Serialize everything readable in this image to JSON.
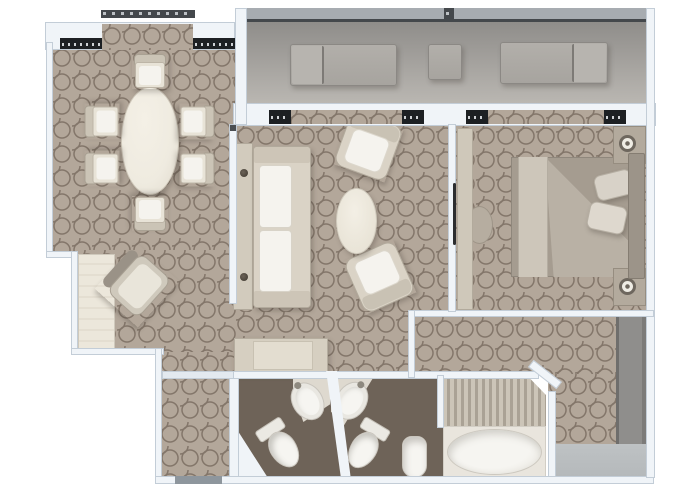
{
  "type": "floor-plan",
  "title": "Suite floor plan (top-down 3D render, no text labels in image)",
  "palette": {
    "background": "#ffffff",
    "wall": "#f0f4f8",
    "wall_edge": "#c3cdd7",
    "carpet": "#b3a79a",
    "carpet_line": "#83766a",
    "balcony_floor_light": "#bab7b2",
    "balcony_floor_dark": "#8e8c89",
    "railing": "#a7acb1",
    "railing_line": "#44484c",
    "window_dark": "#1d2023",
    "cream_furniture": "#dad3c6",
    "cream_edge": "#b2aa9c",
    "cushion_white": "#f5f3ee",
    "table_ivory": "#efebe0",
    "gray_lounger": "#a7a49f",
    "bed_duvet": "#a59c90",
    "bed_fold": "#b9b1a5",
    "bed_runner": "#cdc6ba",
    "pillow": "#d8d2c8",
    "headboard": "#9c9489",
    "nightstand": "#b3aa9d",
    "bath_floor": "#6e6358",
    "fixture_white": "#f6f5f1",
    "fixture_edge": "#c9c5bd",
    "teak_stripe_light": "#ccc5b8",
    "teak_stripe_dark": "#aaa295",
    "tub_deck": "#e9e5dd",
    "wardrobe_gray": "#8f8e8c",
    "closet_mat": "#b5b9bb",
    "threshold": "#8e969d",
    "door_handle": "#2c2d2f"
  },
  "rooms": [
    {
      "name": "balcony",
      "items": [
        {
          "item": "sun-lounger",
          "count": 2
        },
        {
          "item": "side-table",
          "count": 1
        },
        {
          "item": "railing",
          "count": 1
        },
        {
          "item": "sliding-glass-door",
          "count": 2
        }
      ]
    },
    {
      "name": "dining-room",
      "items": [
        {
          "item": "oval-dining-table",
          "count": 1
        },
        {
          "item": "dining-chair",
          "count": 6
        },
        {
          "item": "bay-window",
          "count": 1
        }
      ]
    },
    {
      "name": "living-room",
      "items": [
        {
          "item": "sofa",
          "count": 1
        },
        {
          "item": "console-table",
          "count": 1
        },
        {
          "item": "armchair",
          "count": 2
        },
        {
          "item": "oval-coffee-table",
          "count": 1
        },
        {
          "item": "credenza",
          "count": 1
        },
        {
          "item": "desk",
          "count": 1
        },
        {
          "item": "desk-chair",
          "count": 1
        }
      ]
    },
    {
      "name": "bedroom",
      "items": [
        {
          "item": "double-bed",
          "count": 1
        },
        {
          "item": "pillow",
          "count": 2
        },
        {
          "item": "nightstand-with-lamp",
          "count": 2
        },
        {
          "item": "dresser",
          "count": 1
        },
        {
          "item": "stool",
          "count": 1
        },
        {
          "item": "sliding-door",
          "count": 1
        }
      ]
    },
    {
      "name": "walk-in-closet",
      "items": [
        {
          "item": "wardrobe",
          "count": 1
        },
        {
          "item": "floor-mat",
          "count": 1
        }
      ]
    },
    {
      "name": "master-bathroom",
      "items": [
        {
          "item": "sink",
          "count": 1
        },
        {
          "item": "toilet",
          "count": 1
        },
        {
          "item": "bidet",
          "count": 1
        },
        {
          "item": "bathtub",
          "count": 1
        },
        {
          "item": "teak-shower-floor",
          "count": 1
        }
      ]
    },
    {
      "name": "guest-bathroom",
      "items": [
        {
          "item": "sink",
          "count": 1
        },
        {
          "item": "toilet",
          "count": 1
        }
      ]
    },
    {
      "name": "entry-hall",
      "items": [
        {
          "item": "entrance-threshold",
          "count": 1
        }
      ]
    }
  ]
}
